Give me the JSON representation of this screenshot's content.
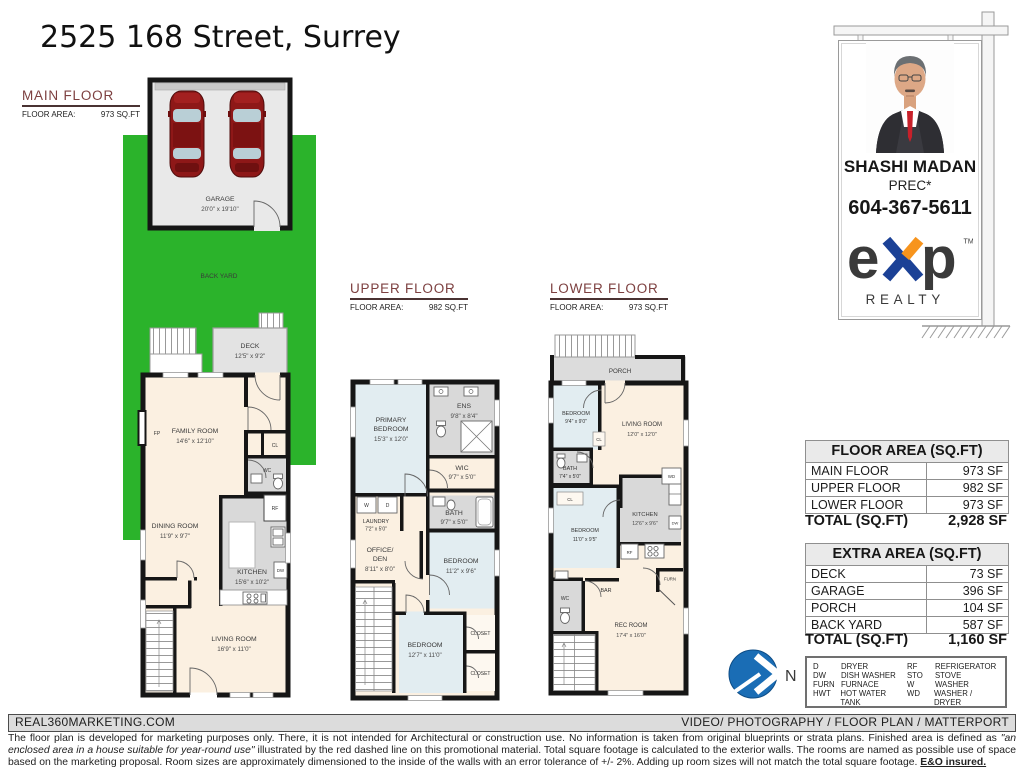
{
  "title": "2525 168 Street, Surrey",
  "headings": {
    "main": {
      "name": "MAIN FLOOR",
      "area_label": "FLOOR AREA:",
      "area": "973 SQ.FT"
    },
    "upper": {
      "name": "UPPER FLOOR",
      "area_label": "FLOOR AREA:",
      "area": "982 SQ.FT"
    },
    "lower": {
      "name": "LOWER FLOOR",
      "area_label": "FLOOR AREA:",
      "area": "973 SQ.FT"
    }
  },
  "main_floor": {
    "garage": {
      "name": "GARAGE",
      "dims": "20'0\" x 19'10\""
    },
    "backyard": "BACK YARD",
    "deck": {
      "name": "DECK",
      "dims": "12'5\" x 9'2\""
    },
    "family": {
      "name": "FAMILY ROOM",
      "dims": "14'6\" x 12'10\""
    },
    "dining": {
      "name": "DINING ROOM",
      "dims": "11'9\" x 9'7\""
    },
    "kitchen": {
      "name": "KITCHEN",
      "dims": "15'6\" x 10'2\""
    },
    "living": {
      "name": "LIVING ROOM",
      "dims": "16'9\" x 11'0\""
    },
    "fp": "FP",
    "cl": "CL",
    "wc": "WC",
    "rf": "RF",
    "dw": "DW"
  },
  "upper_floor": {
    "primary": {
      "name1": "PRIMARY",
      "name2": "BEDROOM",
      "dims": "15'3\" x 12'0\""
    },
    "ens": {
      "name": "ENS",
      "dims": "9'8\" x 8'4\""
    },
    "wic": {
      "name": "WIC",
      "dims": "9'7\" x 5'0\""
    },
    "laundry": {
      "name": "LAUNDRY",
      "dims": "7'2\" x 5'0\"",
      "w": "W",
      "d": "D"
    },
    "bath": {
      "name": "BATH",
      "dims": "9'7\" x 5'0\""
    },
    "office": {
      "name1": "OFFICE/",
      "name2": "DEN",
      "dims": "8'11\" x 8'0\""
    },
    "bedroom2": {
      "name": "BEDROOM",
      "dims": "11'2\" x 9'6\""
    },
    "bedroom3": {
      "name": "BEDROOM",
      "dims": "12'7\" x 11'0\""
    },
    "closet1": "CLOSET",
    "closet2": "CLOSET"
  },
  "lower_floor": {
    "porch": "PORCH",
    "bedroom1": {
      "name": "BEDROOM",
      "dims": "9'4\" x 9'0\""
    },
    "living": {
      "name": "LIVING ROOM",
      "dims": "12'0\" x 12'0\""
    },
    "bath": {
      "name": "BATH",
      "dims": "7'4\" x 5'0\""
    },
    "bedroom2": {
      "name": "BEDROOM",
      "dims": "11'0\" x 9'5\""
    },
    "kitchen": {
      "name": "KITCHEN",
      "dims": "12'6\" x 9'6\""
    },
    "rec": {
      "name": "REC ROOM",
      "dims": "17'4\" x 16'0\""
    },
    "bar": "BAR",
    "wc": "WC",
    "furn": "FURN",
    "wd": "WD",
    "rf": "RF",
    "dw": "DW",
    "cl1": "CL",
    "cl2": "CL"
  },
  "agent": {
    "name": "SHASHI MADAN",
    "designation": "PREC*",
    "phone": "604-367-5611",
    "brand_e": "e",
    "brand_p": "p",
    "brand_sub": "REALTY",
    "brand_tm": "TM",
    "brand_blue": "#1b4196",
    "brand_orange": "#f7941d"
  },
  "compass": {
    "north": "N"
  },
  "tables": {
    "floor_area": {
      "title": "FLOOR AREA (SQ.FT)",
      "rows": [
        {
          "label": "MAIN FLOOR",
          "value": "973 SF"
        },
        {
          "label": "UPPER FLOOR",
          "value": "982 SF"
        },
        {
          "label": "LOWER FLOOR",
          "value": "973 SF"
        }
      ],
      "total_label": "TOTAL (SQ.FT)",
      "total_value": "2,928 SF"
    },
    "extra_area": {
      "title": "EXTRA AREA (SQ.FT)",
      "rows": [
        {
          "label": "DECK",
          "value": "73 SF"
        },
        {
          "label": "GARAGE",
          "value": "396 SF"
        },
        {
          "label": "PORCH",
          "value": "104 SF"
        },
        {
          "label": "BACK YARD",
          "value": "587 SF"
        }
      ],
      "total_label": "TOTAL (SQ.FT)",
      "total_value": "1,160 SF"
    }
  },
  "legend": {
    "items": [
      {
        "abbr": "D",
        "desc": "DRYER"
      },
      {
        "abbr": "DW",
        "desc": "DISH WASHER"
      },
      {
        "abbr": "FURN",
        "desc": "FURNACE"
      },
      {
        "abbr": "HWT",
        "desc": "HOT WATER TANK"
      },
      {
        "abbr": "RF",
        "desc": "REFRIGERATOR"
      },
      {
        "abbr": "STO",
        "desc": "STOVE"
      },
      {
        "abbr": "W",
        "desc": "WASHER"
      },
      {
        "abbr": "WD",
        "desc": "WASHER / DRYER"
      }
    ]
  },
  "footer": {
    "left": "REAL360MARKETING.COM",
    "right": "VIDEO/ PHOTOGRAPHY / FLOOR PLAN / MATTERPORT",
    "disclaimer_1": "The floor plan is developed for marketing purposes only. There, it is not intended for Architectural or construction use. No information is  taken from original blueprints or strata plans. Finished area is defined as  ",
    "disclaimer_2": "\"an enclosed area in a house suitable for year-round use\"",
    "disclaimer_3": " illustrated by the red dashed line on this promotional material. Total square footage is calculated to the exterior walls. The rooms are named as possible use of space based on the marketing proposal. Room sizes are approximately dimensioned to the inside of the walls with an error tolerance of +/- 2%. Adding up room sizes will not match the total square footage. ",
    "disclaimer_4": "E&O insured."
  },
  "colors": {
    "backyard_green": "#2bb32b",
    "room_beige": "#fbf0e1",
    "room_blue": "#e2edf1",
    "room_gray": "#d9d9d9",
    "wall_black": "#161616",
    "heading_maroon": "#7d4040"
  }
}
